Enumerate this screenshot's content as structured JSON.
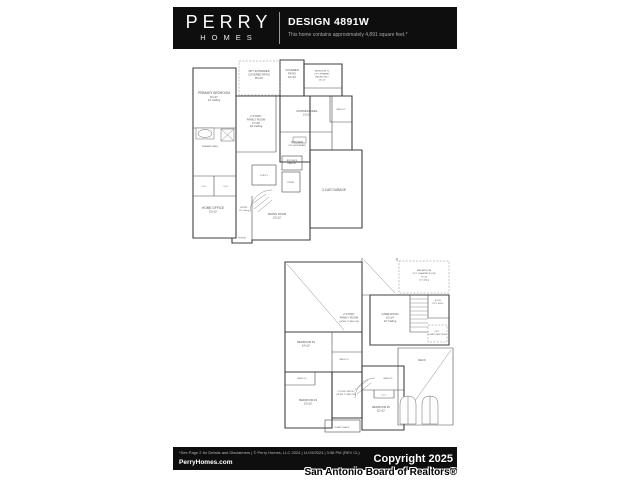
{
  "colors": {
    "bar_bg": "#0e0e0e",
    "wall": "#3f3f3f",
    "page_bg": "#ffffff"
  },
  "header": {
    "brand_top": "PERRY",
    "brand_bottom": "HOMES",
    "title": "DESIGN 4891W",
    "subtitle": "This home contains approximately 4,891 square feet.*"
  },
  "footer": {
    "disclaimer": "*See Page 2 for Details and Disclaimers  |  © Perry Homes, LLC 2024  |  11/19/2024  |  3:58 PM (REV CL)",
    "website": "PerryHomes.com",
    "copyright": "Copyright 2025",
    "attribution": "San Antonio Board of Realtors®"
  },
  "first_floor": {
    "rooms": {
      "primary_bedroom": [
        "PRIMARY BEDROOM",
        "16'x17'",
        "13' Ceiling"
      ],
      "opt_extended_patio": [
        "OPT. EXTENDED",
        "COVERED PATIO",
        "20'x10'"
      ],
      "covered_patio": [
        "COVERED",
        "PATIO",
        "10'x10'"
      ],
      "bedroom2": [
        "BEDROOM #2",
        "OPT. PRIMARY",
        "BEDROOM 2",
        "13'x12'"
      ],
      "family_room": [
        "2 STORY",
        "FAMILY ROOM",
        "17'x19'",
        "19' Ceiling"
      ],
      "morning_area": [
        "MORNING AREA",
        "13'x11'"
      ],
      "bath2": [
        "BATH #2"
      ],
      "kitchen": [
        "KITCHEN",
        "OPT. ALTERNATE"
      ],
      "primary_bath": [
        "PRIMARY BATH"
      ],
      "closet1": [
        "CLO."
      ],
      "closet2": [
        "CLO."
      ],
      "home_office": [
        "HOME OFFICE",
        "13'x12'"
      ],
      "entry": [
        "ENTRY",
        "13' Ceiling"
      ],
      "porch": [
        "PORCH"
      ],
      "utility": [
        "UTILITY"
      ],
      "butlers": [
        "BUTLER'S",
        "PANTRY"
      ],
      "powder": [
        "PWDR."
      ],
      "dining": [
        "DINING ROOM",
        "13'x12'"
      ],
      "garage": [
        "3-CAR GARAGE"
      ]
    }
  },
  "second_floor": {
    "rooms": {
      "family_open": [
        "2 STORY",
        "FAMILY ROOM",
        "(OPEN TO BELOW)"
      ],
      "media_room": [
        "MEDIA ROOM",
        "OPT. THEATRE ROOM",
        "17'x14'",
        "10' Ceiling"
      ],
      "game_room": [
        "GAME ROOM",
        "15'x14'",
        "10' Ceiling"
      ],
      "storage": [
        "STOR.",
        "OPT. ELEV."
      ],
      "computer_desk": [
        "OPT.",
        "COMPUTER DESK"
      ],
      "bedroom3": [
        "BEDROOM #3",
        "14'x12'"
      ],
      "bath3": [
        "BATH #3"
      ],
      "bath4": [
        "BATH #4"
      ],
      "bedroom4": [
        "BEDROOM #4",
        "13'x12'"
      ],
      "entry_open": [
        "2 STORY ENTRY",
        "(OPEN TO BELOW)"
      ],
      "plant_shelf": [
        "PLANT SHELF"
      ],
      "bedroom5": [
        "BEDROOM #5",
        "12'x12'"
      ],
      "clo5": [
        "CLO."
      ],
      "bath5": [
        "BATH #5"
      ],
      "deck": [
        "DECK"
      ]
    }
  }
}
